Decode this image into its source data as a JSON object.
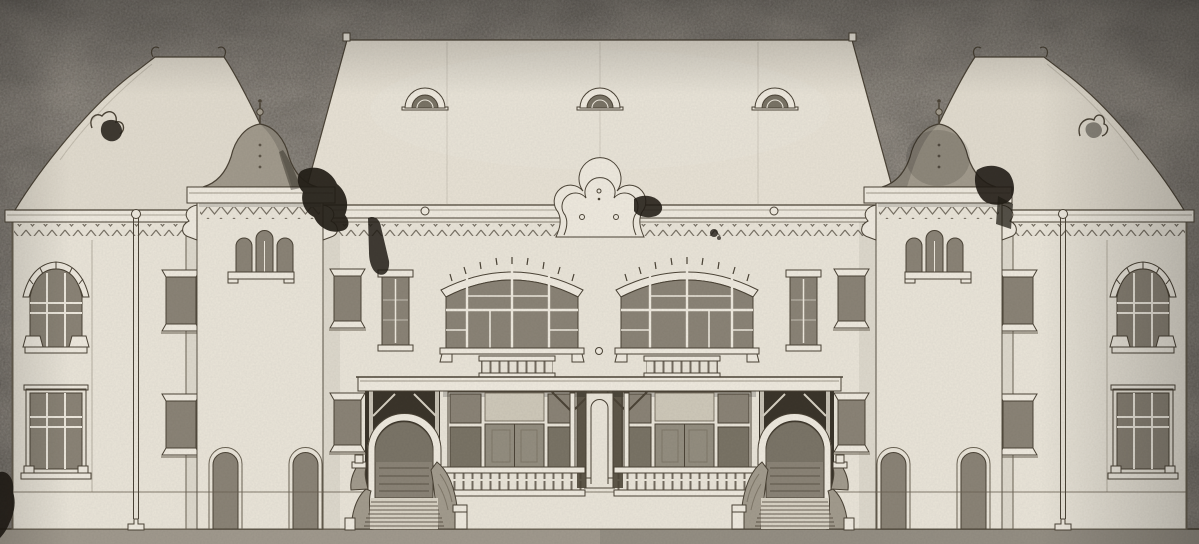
{
  "scene": {
    "subject": "scanned architectural elevation drawing of a symmetrical building facade",
    "building": {
      "wings": 2,
      "towers_with_domes": 2,
      "roof_dormer_vents": 3,
      "central_gable_shape": "trefoil",
      "large_arched_upper_windows": 2,
      "veranda_balustrade_sections": 2,
      "arched_entrances_with_stairs": 2,
      "tower_triple_arch_windows": 2,
      "drainpipes": 2
    }
  },
  "colors": {
    "paper": "#948d83",
    "paper_dark": "#7e7870",
    "wall": "#eae5d9",
    "trim": "#efeadf",
    "roof_center": "#e8e2d5",
    "roof_wing": "#e2dccf",
    "dome": "#a29b8d",
    "window": "#8b8477",
    "window_deep": "#7a7466",
    "door": "#948e80",
    "transom_light": "#cfc9ba",
    "line": "#4c4437",
    "line_soft": "#6b6354",
    "ink": "#221d16",
    "ground": "#a19a8e",
    "porch_shadow": "#3b352b",
    "veranda_shadow": "#5e5749",
    "cheek": "#a39c8e",
    "step": "#d9d3c5"
  }
}
